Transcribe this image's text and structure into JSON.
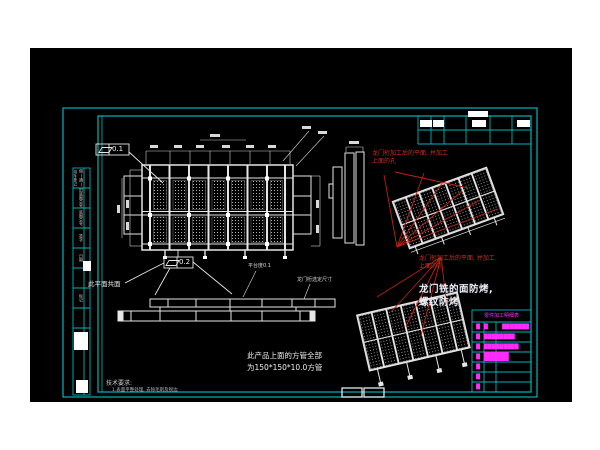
{
  "colors": {
    "canvas": "#000000",
    "page": "#ffffff",
    "frame_cyan": "#00b4b8",
    "linework_white": "#e6e6e6",
    "annotation_red": "#c23321",
    "bom_magenta": "#ff2bff"
  },
  "gdt": {
    "top": {
      "symbol_name": "flatness",
      "value": "0.1"
    },
    "bottom": {
      "symbol_name": "flatness",
      "value": "0.2"
    }
  },
  "annotations": {
    "coplanar": "此平面共面",
    "platform_flatness": "平台度0.1",
    "gantry_dim": "龙门桁选定尺寸",
    "square_tube_1": "此产品上面的方管全部",
    "square_tube_2": "为150*150*10.0方管",
    "machining_1": "龙门桁加工后的平面, 并加工",
    "machining_2": "上面的孔",
    "milling_1": "龙门铣的面防烤,",
    "milling_2": "螺纹防烤"
  },
  "tech": {
    "title": "技术要求:",
    "item_1": "1.表面平整处理, 去除毛刺及锐边"
  },
  "bom": {
    "header": "零件加工明细表",
    "rows": [
      {
        "a": "█",
        "b": "█",
        "c": "███████"
      },
      {
        "a": "█",
        "b": "████████",
        "c": ""
      },
      {
        "a": "█",
        "b": "█████████",
        "c": ""
      },
      {
        "a": "█",
        "b": "████",
        "c": ""
      },
      {
        "a": "█",
        "b": "",
        "c": ""
      },
      {
        "a": "█",
        "b": "",
        "c": ""
      },
      {
        "a": "█",
        "b": "",
        "c": ""
      }
    ]
  },
  "frame_labels": {
    "cells": [
      "借(通)用件登记",
      "旧底图总号",
      "底图总号",
      "签字",
      "日期",
      "标记"
    ]
  }
}
